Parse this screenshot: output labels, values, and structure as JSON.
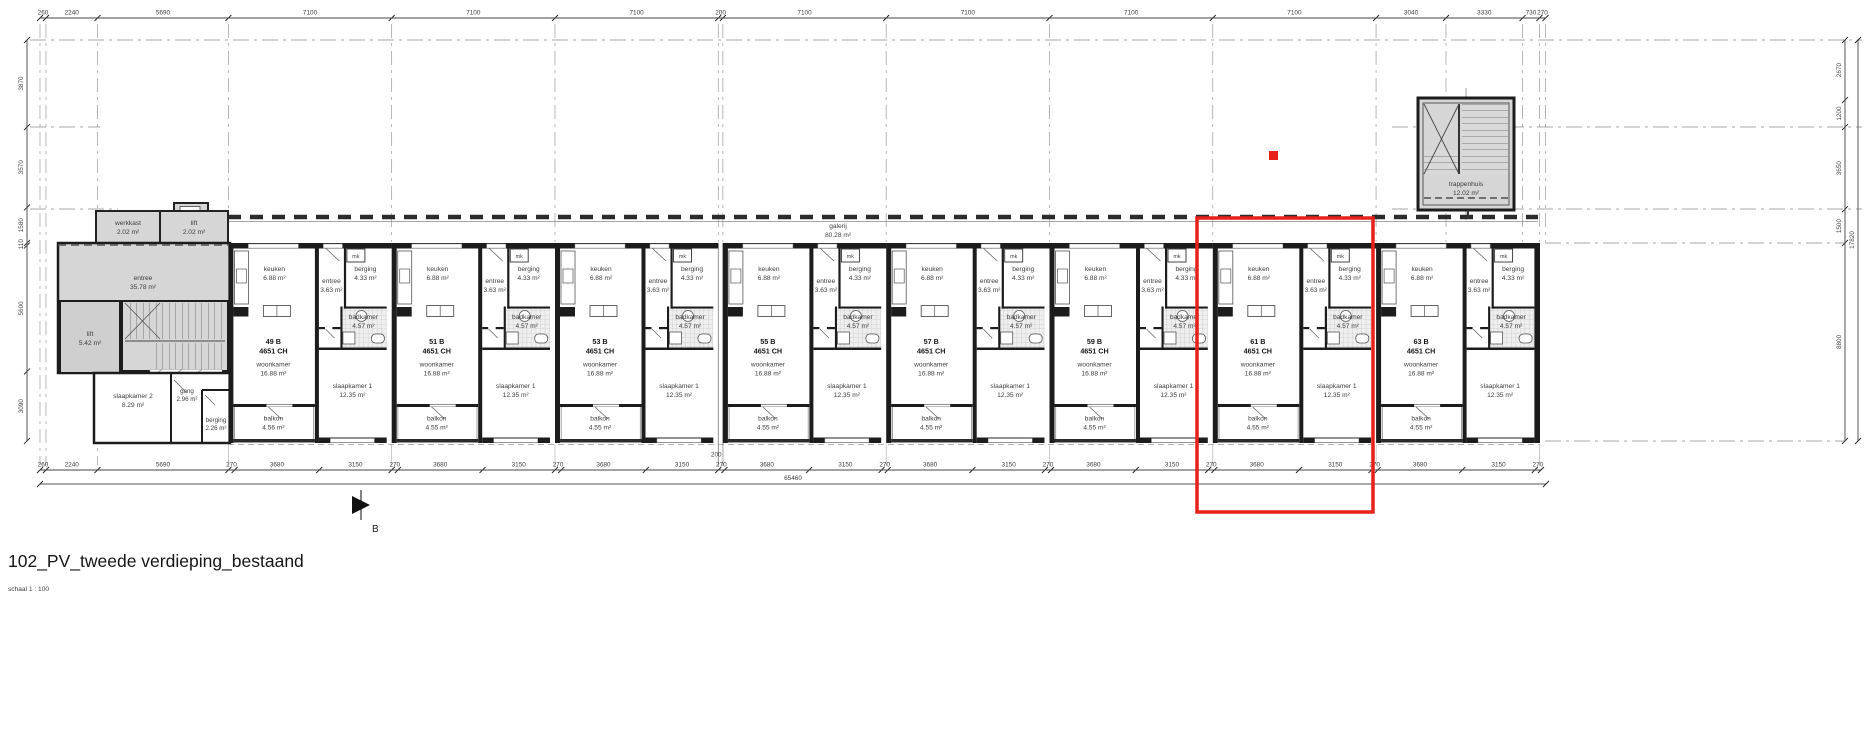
{
  "title_block": {
    "title": "102_PV_tweede verdieping_bestaand",
    "scale_label": "schaal 1 : 100"
  },
  "colors": {
    "highlight_red": "#e8201a",
    "wall_dark": "#1c1c1c",
    "common_grey": "#d6d6d6"
  },
  "dimensions": {
    "top": [
      "260",
      "2240",
      "5690",
      "7100",
      "7100",
      "7100",
      "200",
      "7100",
      "7100",
      "7100",
      "7100",
      "3040",
      "3330",
      "730",
      "270"
    ],
    "bottom": [
      "260",
      "2240",
      "5690",
      "270",
      "3680",
      "3150",
      "270",
      "3680",
      "3150",
      "270",
      "3680",
      "3150",
      "270",
      "3680",
      "3150",
      "270",
      "3680",
      "3150",
      "270",
      "3680",
      "3150",
      "270",
      "3680",
      "3150",
      "270",
      "3680",
      "3150",
      "270"
    ],
    "bottom_junction": "200",
    "bottom_total": "65460",
    "left": [
      "3870",
      "3570",
      "1580",
      "110",
      "5600",
      "3090"
    ],
    "right": [
      "2670",
      "1200",
      "3650",
      "1500",
      "8800"
    ],
    "right_total": "17820"
  },
  "room_labels": {
    "keuken": "keuken",
    "entree": "entree",
    "berging": "berging",
    "badkamer": "badkamer",
    "woonkamer": "woonkamer",
    "slaapkamer": "slaapkamer 1",
    "balkon": "balkon",
    "mk": "mk"
  },
  "units": [
    {
      "number": "49 B",
      "code": "4651 CH",
      "keuken": "6.88 m²",
      "entree": "3.63 m²",
      "berging": "4.33 m²",
      "badkamer": "4.57 m²",
      "woonkamer": "16.88 m²",
      "slaapkamer": "12.35 m²",
      "balkon": "4.56 m²"
    },
    {
      "number": "51 B",
      "code": "4651 CH",
      "keuken": "6.88 m²",
      "entree": "3.63 m²",
      "berging": "4.33 m²",
      "badkamer": "4.57 m²",
      "woonkamer": "16.88 m²",
      "slaapkamer": "12.35 m²",
      "balkon": "4.55 m²"
    },
    {
      "number": "53 B",
      "code": "4651 CH",
      "keuken": "6.88 m²",
      "entree": "3.63 m²",
      "berging": "4.33 m²",
      "badkamer": "4.57 m²",
      "woonkamer": "16.88 m²",
      "slaapkamer": "12.35 m²",
      "balkon": "4.55 m²"
    },
    {
      "number": "55 B",
      "code": "4651 CH",
      "keuken": "6.88 m²",
      "entree": "3.63 m²",
      "berging": "4.33 m²",
      "badkamer": "4.57 m²",
      "woonkamer": "16.88 m²",
      "slaapkamer": "12.35 m²",
      "balkon": "4.55 m²"
    },
    {
      "number": "57 B",
      "code": "4651 CH",
      "keuken": "6.88 m²",
      "entree": "3.63 m²",
      "berging": "4.33 m²",
      "badkamer": "4.57 m²",
      "woonkamer": "16.88 m²",
      "slaapkamer": "12.35 m²",
      "balkon": "4.55 m²"
    },
    {
      "number": "59 B",
      "code": "4651 CH",
      "keuken": "6.88 m²",
      "entree": "3.63 m²",
      "berging": "4.33 m²",
      "badkamer": "4.57 m²",
      "woonkamer": "16.88 m²",
      "slaapkamer": "12.35 m²",
      "balkon": "4.55 m²"
    },
    {
      "number": "61 B",
      "code": "4651 CH",
      "keuken": "6.88 m²",
      "entree": "3.63 m²",
      "berging": "4.33 m²",
      "badkamer": "4.57 m²",
      "woonkamer": "16.88 m²",
      "slaapkamer": "12.35 m²",
      "balkon": "4.55 m²"
    },
    {
      "number": "63 B",
      "code": "4651 CH",
      "keuken": "6.88 m²",
      "entree": "3.63 m²",
      "berging": "4.33 m²",
      "badkamer": "4.57 m²",
      "woonkamer": "16.88 m²",
      "slaapkamer": "12.35 m²",
      "balkon": "4.55 m²"
    }
  ],
  "common": {
    "werkkast": {
      "name": "werkkast",
      "area": "2.02 m²"
    },
    "lift_klein": {
      "name": "lift",
      "area": "2.02 m²"
    },
    "entree_hal": {
      "name": "entree",
      "area": "35.78 m²"
    },
    "lift_groot": {
      "name": "lift",
      "area": "5.42 m²"
    },
    "slaapkamer2": {
      "name": "slaapkamer 2",
      "area": "8.29 m²"
    },
    "gang": {
      "name": "gang",
      "area": "2.96 m²"
    },
    "berging": {
      "name": "berging",
      "area": "2.26 m²"
    },
    "galerij": {
      "name": "galerij",
      "area": "80.28 m²"
    },
    "trappenhuis": {
      "name": "trappenhuis",
      "area": "12.02 m²"
    }
  },
  "markers": {
    "section_label": "B"
  }
}
